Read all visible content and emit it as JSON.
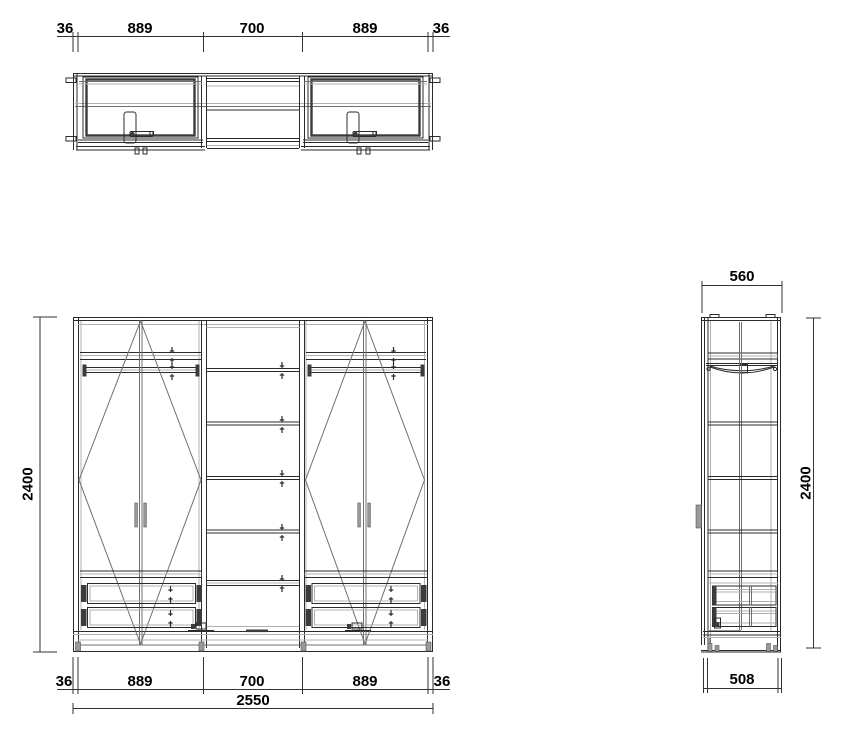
{
  "meta": {
    "drawing_title": "Wardrobe technical drawing — plan, front and side views",
    "units": "mm"
  },
  "colors": {
    "background": "#ffffff",
    "line_main": "#2b2b2b",
    "line_light": "#b0b0b0",
    "line_mid": "#6f6f6f",
    "dimension_text": "#000000"
  },
  "views": {
    "plan": {
      "name": "plan-view"
    },
    "front": {
      "name": "front-elevation"
    },
    "side": {
      "name": "side-elevation"
    }
  },
  "dimensions": {
    "plan_top": {
      "segments": [
        "36",
        "889",
        "700",
        "889",
        "36"
      ]
    },
    "front_bottom": {
      "segments": [
        "36",
        "889",
        "700",
        "889",
        "36"
      ],
      "total": "2550"
    },
    "front_height": "2400",
    "side_top_width": "560",
    "side_height": "2400",
    "side_bottom_width": "508"
  }
}
